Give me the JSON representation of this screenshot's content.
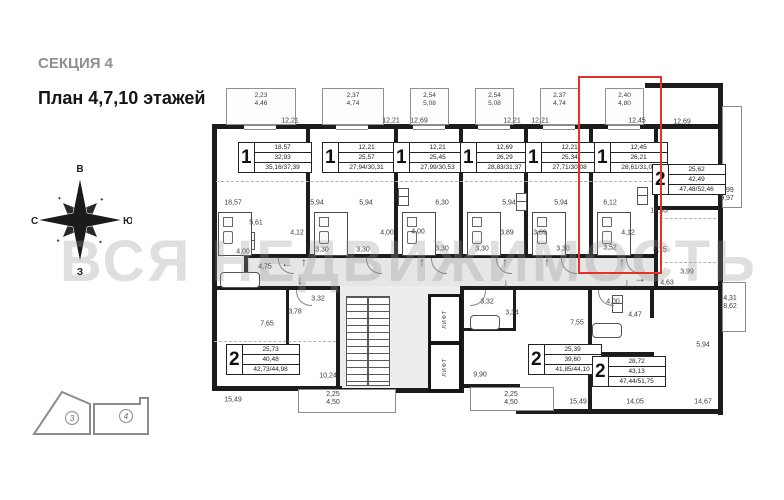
{
  "header": {
    "section_title": "СЕКЦИЯ 4",
    "plan_title": "План 4,7,10 этажей"
  },
  "watermark": "ВСЯ НЕДВИЖИМОСТЬ",
  "compass": {
    "top": "В",
    "left": "С",
    "right": "Ю",
    "bottom": "З"
  },
  "key_plan": {
    "section_left": "3",
    "section_right": "4"
  },
  "colors": {
    "highlight": "#e6332a",
    "wall": "#1c1c1c",
    "corridor_fill": "#e6e6e6"
  },
  "elevator_label": "ЛИФТ",
  "plan": {
    "top_units": [
      {
        "col_x": 212,
        "col_w": 96,
        "balcony_line1": "2,23",
        "balcony_line2": "4,46"
      },
      {
        "col_x": 308,
        "col_w": 88,
        "balcony_line1": "2,37",
        "balcony_line2": "4,74"
      },
      {
        "col_x": 396,
        "col_w": 65,
        "balcony_line1": "2,54",
        "balcony_line2": "5,08"
      },
      {
        "col_x": 461,
        "col_w": 65,
        "balcony_line1": "2,54",
        "balcony_line2": "5,08"
      },
      {
        "col_x": 526,
        "col_w": 65,
        "balcony_line1": "2,37",
        "balcony_line2": "4,74"
      },
      {
        "col_x": 591,
        "col_w": 65,
        "balcony_line1": "2,40",
        "balcony_line2": "4,80"
      }
    ],
    "unit_boxes": [
      {
        "type": "1",
        "rows": [
          "18,57",
          "32,93",
          "35,16/37,39"
        ],
        "x": 238,
        "y": 142,
        "highlighted": false
      },
      {
        "type": "1",
        "rows": [
          "12,21",
          "25,57",
          "27,94/30,31"
        ],
        "x": 322,
        "y": 142,
        "highlighted": false
      },
      {
        "type": "1",
        "rows": [
          "12,21",
          "25,45",
          "27,99/30,53"
        ],
        "x": 393,
        "y": 142,
        "highlighted": false
      },
      {
        "type": "1",
        "rows": [
          "12,69",
          "26,29",
          "28,83/31,37"
        ],
        "x": 460,
        "y": 142,
        "highlighted": false
      },
      {
        "type": "1",
        "rows": [
          "12,21",
          "25,34",
          "27,71/30,08"
        ],
        "x": 525,
        "y": 142,
        "highlighted": false
      },
      {
        "type": "1",
        "rows": [
          "12,45",
          "26,21",
          "28,61/31,01"
        ],
        "x": 594,
        "y": 142,
        "highlighted": true
      },
      {
        "type": "2",
        "rows": [
          "25,62",
          "42,49",
          "47,48/52,46"
        ],
        "x": 652,
        "y": 164,
        "highlighted": false
      },
      {
        "type": "2",
        "rows": [
          "25,73",
          "40,48",
          "42,73/44,98"
        ],
        "x": 226,
        "y": 344,
        "highlighted": false
      },
      {
        "type": "2",
        "rows": [
          "25,39",
          "39,60",
          "41,85/44,10"
        ],
        "x": 528,
        "y": 344,
        "highlighted": false
      },
      {
        "type": "2",
        "rows": [
          "28,72",
          "43,13",
          "47,44/51,75"
        ],
        "x": 592,
        "y": 356,
        "highlighted": false
      }
    ],
    "dim_labels": [
      {
        "t": "12,21",
        "x": 290,
        "y": 121
      },
      {
        "t": "12,21",
        "x": 391,
        "y": 121
      },
      {
        "t": "12,69",
        "x": 419,
        "y": 121
      },
      {
        "t": "12,21",
        "x": 512,
        "y": 121
      },
      {
        "t": "12,21",
        "x": 540,
        "y": 121
      },
      {
        "t": "12,45",
        "x": 637,
        "y": 121
      },
      {
        "t": "12,69",
        "x": 682,
        "y": 122
      },
      {
        "t": "18,57",
        "x": 233,
        "y": 203
      },
      {
        "t": "5,94",
        "x": 317,
        "y": 203
      },
      {
        "t": "5,94",
        "x": 366,
        "y": 203
      },
      {
        "t": "6,30",
        "x": 442,
        "y": 203
      },
      {
        "t": "5,94",
        "x": 509,
        "y": 203
      },
      {
        "t": "5,94",
        "x": 561,
        "y": 203
      },
      {
        "t": "6,12",
        "x": 610,
        "y": 203
      },
      {
        "t": "12,93",
        "x": 659,
        "y": 211
      },
      {
        "t": "5,61",
        "x": 256,
        "y": 223
      },
      {
        "t": "4,12",
        "x": 297,
        "y": 233
      },
      {
        "t": "4,00",
        "x": 387,
        "y": 233
      },
      {
        "t": "4,00",
        "x": 418,
        "y": 232
      },
      {
        "t": "3,89",
        "x": 507,
        "y": 233
      },
      {
        "t": "3,89",
        "x": 540,
        "y": 233
      },
      {
        "t": "4,12",
        "x": 628,
        "y": 233
      },
      {
        "t": "4,00",
        "x": 243,
        "y": 252
      },
      {
        "t": "3,30",
        "x": 322,
        "y": 250
      },
      {
        "t": "3,30",
        "x": 363,
        "y": 250
      },
      {
        "t": "3,30",
        "x": 442,
        "y": 249
      },
      {
        "t": "3,30",
        "x": 482,
        "y": 249
      },
      {
        "t": "3,30",
        "x": 563,
        "y": 249
      },
      {
        "t": "3,52",
        "x": 610,
        "y": 248
      },
      {
        "t": "8,15",
        "x": 660,
        "y": 250
      },
      {
        "t": "4,75",
        "x": 265,
        "y": 267
      },
      {
        "t": "3,78",
        "x": 295,
        "y": 312
      },
      {
        "t": "3,32",
        "x": 318,
        "y": 299
      },
      {
        "t": "7,65",
        "x": 267,
        "y": 324
      },
      {
        "t": "3,32",
        "x": 487,
        "y": 302
      },
      {
        "t": "3,34",
        "x": 512,
        "y": 313
      },
      {
        "t": "7,55",
        "x": 577,
        "y": 323
      },
      {
        "t": "4,00",
        "x": 613,
        "y": 302
      },
      {
        "t": "4,47",
        "x": 635,
        "y": 315
      },
      {
        "t": "3,99",
        "x": 687,
        "y": 272
      },
      {
        "t": "4,63",
        "x": 667,
        "y": 283
      },
      {
        "t": "5,94",
        "x": 703,
        "y": 345
      },
      {
        "t": "10,24",
        "x": 328,
        "y": 376
      },
      {
        "t": "15,49",
        "x": 233,
        "y": 400
      },
      {
        "t": "9,90",
        "x": 480,
        "y": 375
      },
      {
        "t": "15,49",
        "x": 578,
        "y": 402
      },
      {
        "t": "14,05",
        "x": 635,
        "y": 402
      },
      {
        "t": "14,67",
        "x": 703,
        "y": 402
      }
    ],
    "two_line_labels": [
      {
        "l1": "4,99",
        "l2": "9,97",
        "x": 727,
        "y": 195
      },
      {
        "l1": "4,31",
        "l2": "8,62",
        "x": 730,
        "y": 303
      },
      {
        "l1": "2,25",
        "l2": "4,50",
        "x": 333,
        "y": 399
      },
      {
        "l1": "2,25",
        "l2": "4,50",
        "x": 511,
        "y": 399
      }
    ],
    "arrows": [
      {
        "s": "←",
        "x": 287,
        "y": 263
      },
      {
        "s": "↑",
        "x": 304,
        "y": 262
      },
      {
        "s": "↓",
        "x": 300,
        "y": 280
      },
      {
        "s": "↑",
        "x": 422,
        "y": 262
      },
      {
        "s": "↑",
        "x": 505,
        "y": 262
      },
      {
        "s": "↓",
        "x": 506,
        "y": 283
      },
      {
        "s": "↑",
        "x": 547,
        "y": 262
      },
      {
        "s": "↑",
        "x": 622,
        "y": 262
      },
      {
        "s": "↓",
        "x": 627,
        "y": 283
      },
      {
        "s": "→",
        "x": 640,
        "y": 278
      }
    ]
  }
}
